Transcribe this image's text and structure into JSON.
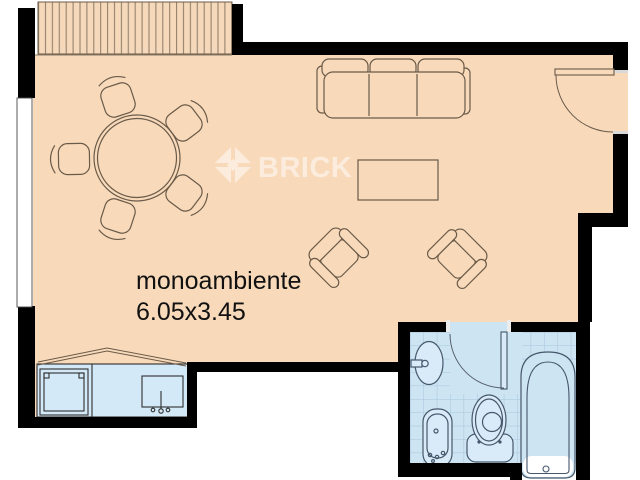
{
  "room": {
    "label": "monoambiente",
    "dimensions": "6.05x3.45"
  },
  "watermark": {
    "brand": "BRICK"
  },
  "colors": {
    "wall": "#000000",
    "floor": "#f8dabb",
    "deck_stripe": "#8d7b66",
    "furniture_outline": "#6a5a48",
    "wet_area_fill": "#cde4f3",
    "tile_line": "#a6c6dd",
    "fixture_fill": "#d9ebf8",
    "fixture_outline": "#45576b",
    "label_text": "#111111",
    "watermark_color": "#ffffff"
  }
}
